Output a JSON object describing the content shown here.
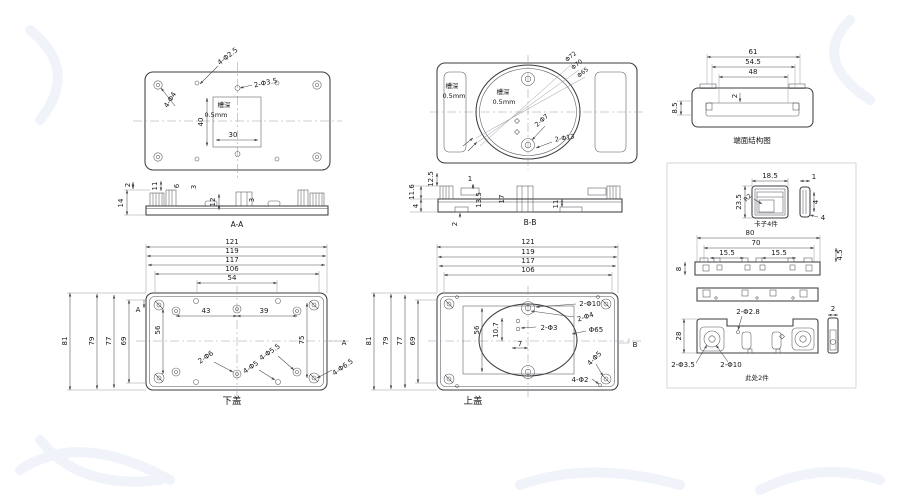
{
  "drawing": {
    "top_left_view": {
      "holes_small": "4-Φ2.5",
      "holes_corner": "4-Φ4",
      "holes_center": "2-Φ3.5",
      "groove_label": "槽深",
      "groove_depth": "0.5mm",
      "groove_w": "30",
      "groove_h": "40"
    },
    "top_center_view": {
      "left_groove_label": "槽深",
      "left_groove_depth": "0.5mm",
      "groove_label": "槽深",
      "groove_depth": "0.5mm",
      "dia_outer": "Φ72",
      "dia_mid": "Φ70",
      "dia_inner": "Φ65",
      "holes_7": "2-Φ7",
      "holes_13": "2-Φ13"
    },
    "end_face_view": {
      "w_outer": "61",
      "w_mid": "54.5",
      "w_inner": "48",
      "step": "2",
      "height": "8.5",
      "caption": "端面结构图"
    },
    "section_aa": {
      "caption": "A-A",
      "t2": "2",
      "t14": "14",
      "t11": "11",
      "t6": "6",
      "t3a": "3",
      "t12": "12",
      "t3b": "3"
    },
    "section_bb": {
      "caption": "B-B",
      "t125": "12.5",
      "t116": "11.6",
      "t4": "4",
      "t1": "1",
      "t135": "13.5",
      "t17": "17",
      "t11": "11",
      "t2": "2"
    },
    "bottom_cover_view": {
      "caption": "下盖",
      "w121": "121",
      "w119": "119",
      "w117": "117",
      "w106": "106",
      "w54": "54",
      "w43": "43",
      "w39": "39",
      "h81": "81",
      "h79": "79",
      "h77": "77",
      "h69": "69",
      "h56": "56",
      "h75": "75",
      "holes_2d6": "2-Φ6",
      "holes_4d5": "4-Φ5",
      "holes_4d55": "4-Φ5.5",
      "holes_4d65": "4-Φ6.5",
      "marker_left": "A",
      "marker_right": "A"
    },
    "top_cover_view": {
      "caption": "上盖",
      "w121": "121",
      "w119": "119",
      "w117": "117",
      "w106": "106",
      "h81": "81",
      "h79": "79",
      "h77": "77",
      "h69": "69",
      "h56": "56",
      "h107": "10.7",
      "h7": "7",
      "holes_2d10": "2-Φ10",
      "holes_2d4": "2-Φ4",
      "holes_2d3": "2-Φ3",
      "dia65": "Φ65",
      "holes_4d5": "4-Φ5",
      "holes_4d2": "4-Φ2",
      "marker_right": "B"
    },
    "clip_detail": {
      "caption": "卡子4件",
      "w": "18.5",
      "h": "23.5",
      "radius": "R2",
      "side_w": "1",
      "side_t": "4",
      "side_b": "4"
    },
    "rail_detail": {
      "w80": "80",
      "w70": "70",
      "w155a": "15.5",
      "w155b": "15.5",
      "h8": "8",
      "h45": "4.5"
    },
    "foot_detail": {
      "caption": "此处2件",
      "h28": "28",
      "holes_2d28": "2-Φ2.8",
      "w2": "2",
      "holes_2d35": "2-Φ3.5",
      "holes_2d10": "2-Φ10"
    }
  }
}
